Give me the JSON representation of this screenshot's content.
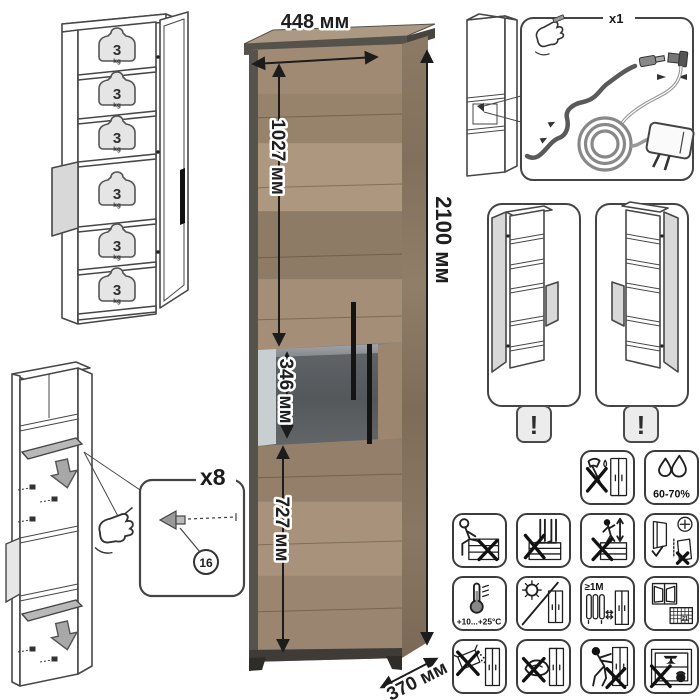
{
  "dimensions": {
    "width": "448 мм",
    "height": "2100 мм",
    "depth": "370 мм",
    "upper_section": "1027 мм",
    "middle_section": "346 мм",
    "lower_section": "727 мм"
  },
  "shelf_capacity": {
    "value": "3",
    "unit": "kg"
  },
  "led_kit": {
    "quantity": "x1"
  },
  "shelf_supports": {
    "quantity": "x8",
    "part_number": "16"
  },
  "door_reversible": {
    "warning": "!"
  },
  "care": {
    "humidity": "60-70%",
    "temperature": "+10...+25°C",
    "heat_distance": "≥1M",
    "calendar_day": "21"
  },
  "colors": {
    "wood": "#a6907a",
    "wood_dark": "#8a7763",
    "frame": "#54514b",
    "glass": "#5a5e60",
    "line_art": "#474747",
    "dimension_text": "#1f1f1f",
    "badge_bg": "#ececec"
  }
}
